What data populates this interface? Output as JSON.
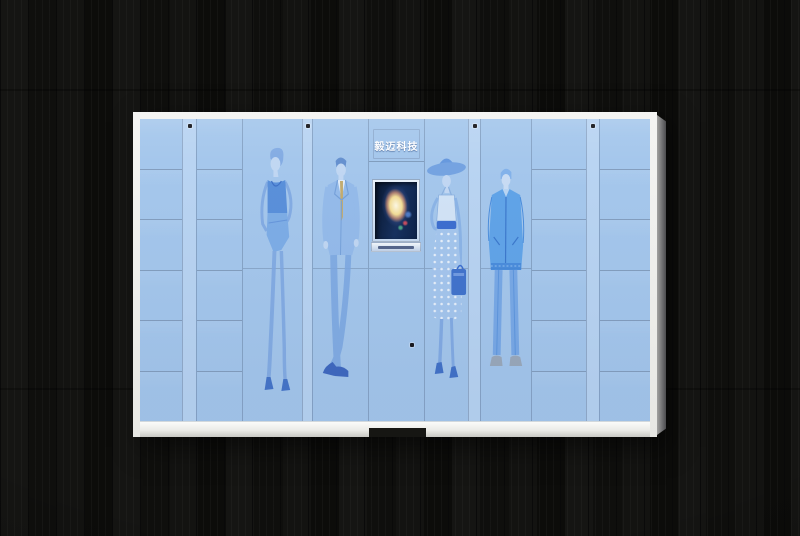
{
  "scene": {
    "type": "product-photo",
    "subject": "smart parcel locker cabinet with blue fashion-sketch door wrap",
    "background": {
      "material": "dark wood planks",
      "base_color": "#101010"
    }
  },
  "locker": {
    "console": {
      "brand_text": "毅迈科技",
      "brand_text_color": "#ffffff",
      "screen_frame_color": "#13294e",
      "screen_glow_color": "#f8f0d4",
      "tray_color": "#dce8f6"
    },
    "colors": {
      "door_blue": "#a5c7ec",
      "hinge_blue": "#b9d4f2",
      "frame_white": "#efefed",
      "seam_gray": "#7d90aa",
      "side_panel_gray": "#7b7b7d",
      "illustration_blue": "#4d87d8",
      "lock_dot": "#17171c",
      "base_notch": "#161613"
    },
    "rows_per_cell_column": 6,
    "columns": [
      {
        "type": "cells",
        "name": "cell-column-far-left",
        "width": 42
      },
      {
        "type": "hinge",
        "name": "hinge-strip-1",
        "width": 14,
        "lock": true
      },
      {
        "type": "cells",
        "name": "cell-column-left",
        "width": 46
      },
      {
        "type": "panel",
        "name": "panel-woman-standing",
        "figure": "woman-standing",
        "width": 60
      },
      {
        "type": "hinge",
        "name": "hinge-strip-2",
        "width": 10,
        "lock": true
      },
      {
        "type": "panel",
        "name": "panel-man-suit",
        "figure": "man-suit",
        "width": 56
      },
      {
        "type": "console",
        "name": "console-column",
        "width": 56
      },
      {
        "type": "panel",
        "name": "panel-woman-hat",
        "figure": "woman-hat",
        "width": 44
      },
      {
        "type": "hinge",
        "name": "hinge-strip-3",
        "width": 12,
        "lock": true
      },
      {
        "type": "panel",
        "name": "panel-man-jacket",
        "figure": "man-jacket",
        "width": 51
      },
      {
        "type": "cells",
        "name": "cell-column-right",
        "width": 55
      },
      {
        "type": "hinge",
        "name": "hinge-strip-4",
        "width": 13,
        "lock": true
      },
      {
        "type": "cells",
        "name": "cell-column-far-right",
        "width": 51
      }
    ]
  }
}
